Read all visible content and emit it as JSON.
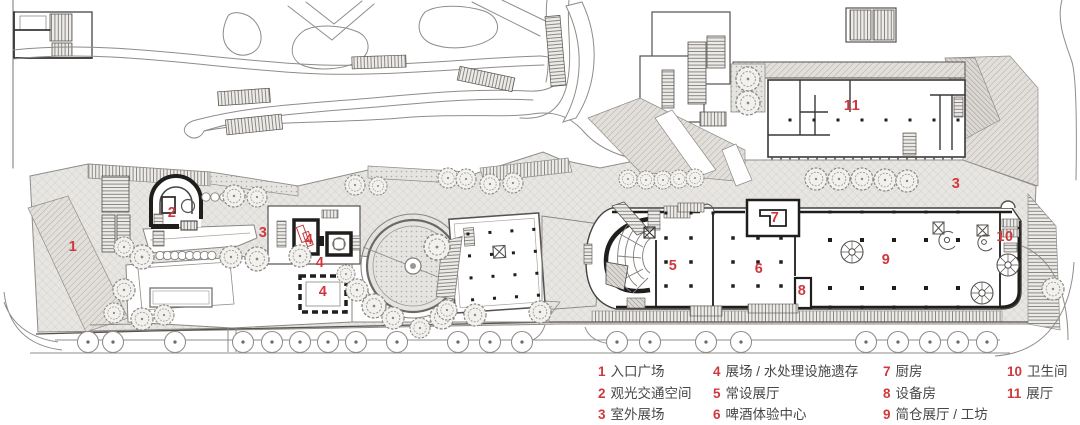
{
  "plan": {
    "labels": [
      {
        "num": "1",
        "x": 73,
        "y": 247
      },
      {
        "num": "2",
        "x": 172,
        "y": 213
      },
      {
        "num": "3",
        "x": 263,
        "y": 233
      },
      {
        "num": "4",
        "x": 309,
        "y": 240
      },
      {
        "num": "4",
        "x": 320,
        "y": 263
      },
      {
        "num": "4",
        "x": 323,
        "y": 292
      },
      {
        "num": "3",
        "x": 956,
        "y": 184
      },
      {
        "num": "5",
        "x": 673,
        "y": 266
      },
      {
        "num": "6",
        "x": 759,
        "y": 269
      },
      {
        "num": "7",
        "x": 775,
        "y": 218
      },
      {
        "num": "8",
        "x": 802,
        "y": 291
      },
      {
        "num": "9",
        "x": 886,
        "y": 260
      },
      {
        "num": "10",
        "x": 1005,
        "y": 237
      },
      {
        "num": "11",
        "x": 852,
        "y": 106
      }
    ]
  },
  "legend": {
    "columns": [
      {
        "left": 598,
        "items": [
          {
            "num": "1",
            "label": "入口广场"
          },
          {
            "num": "2",
            "label": "观光交通空间"
          },
          {
            "num": "3",
            "label": "室外展场"
          }
        ]
      },
      {
        "left": 713,
        "items": [
          {
            "num": "4",
            "label": "展场 / 水处理设施遗存"
          },
          {
            "num": "5",
            "label": "常设展厅"
          },
          {
            "num": "6",
            "label": "啤酒体验中心"
          }
        ]
      },
      {
        "left": 883,
        "items": [
          {
            "num": "7",
            "label": "厨房"
          },
          {
            "num": "8",
            "label": "设备房"
          },
          {
            "num": "9",
            "label": "简仓展厅 / 工坊"
          }
        ]
      },
      {
        "left": 1007,
        "items": [
          {
            "num": "10",
            "label": "卫生间"
          },
          {
            "num": "11",
            "label": "展厅"
          }
        ]
      }
    ]
  },
  "colors": {
    "label_red": "#cf393d",
    "text_gray": "#474747"
  }
}
